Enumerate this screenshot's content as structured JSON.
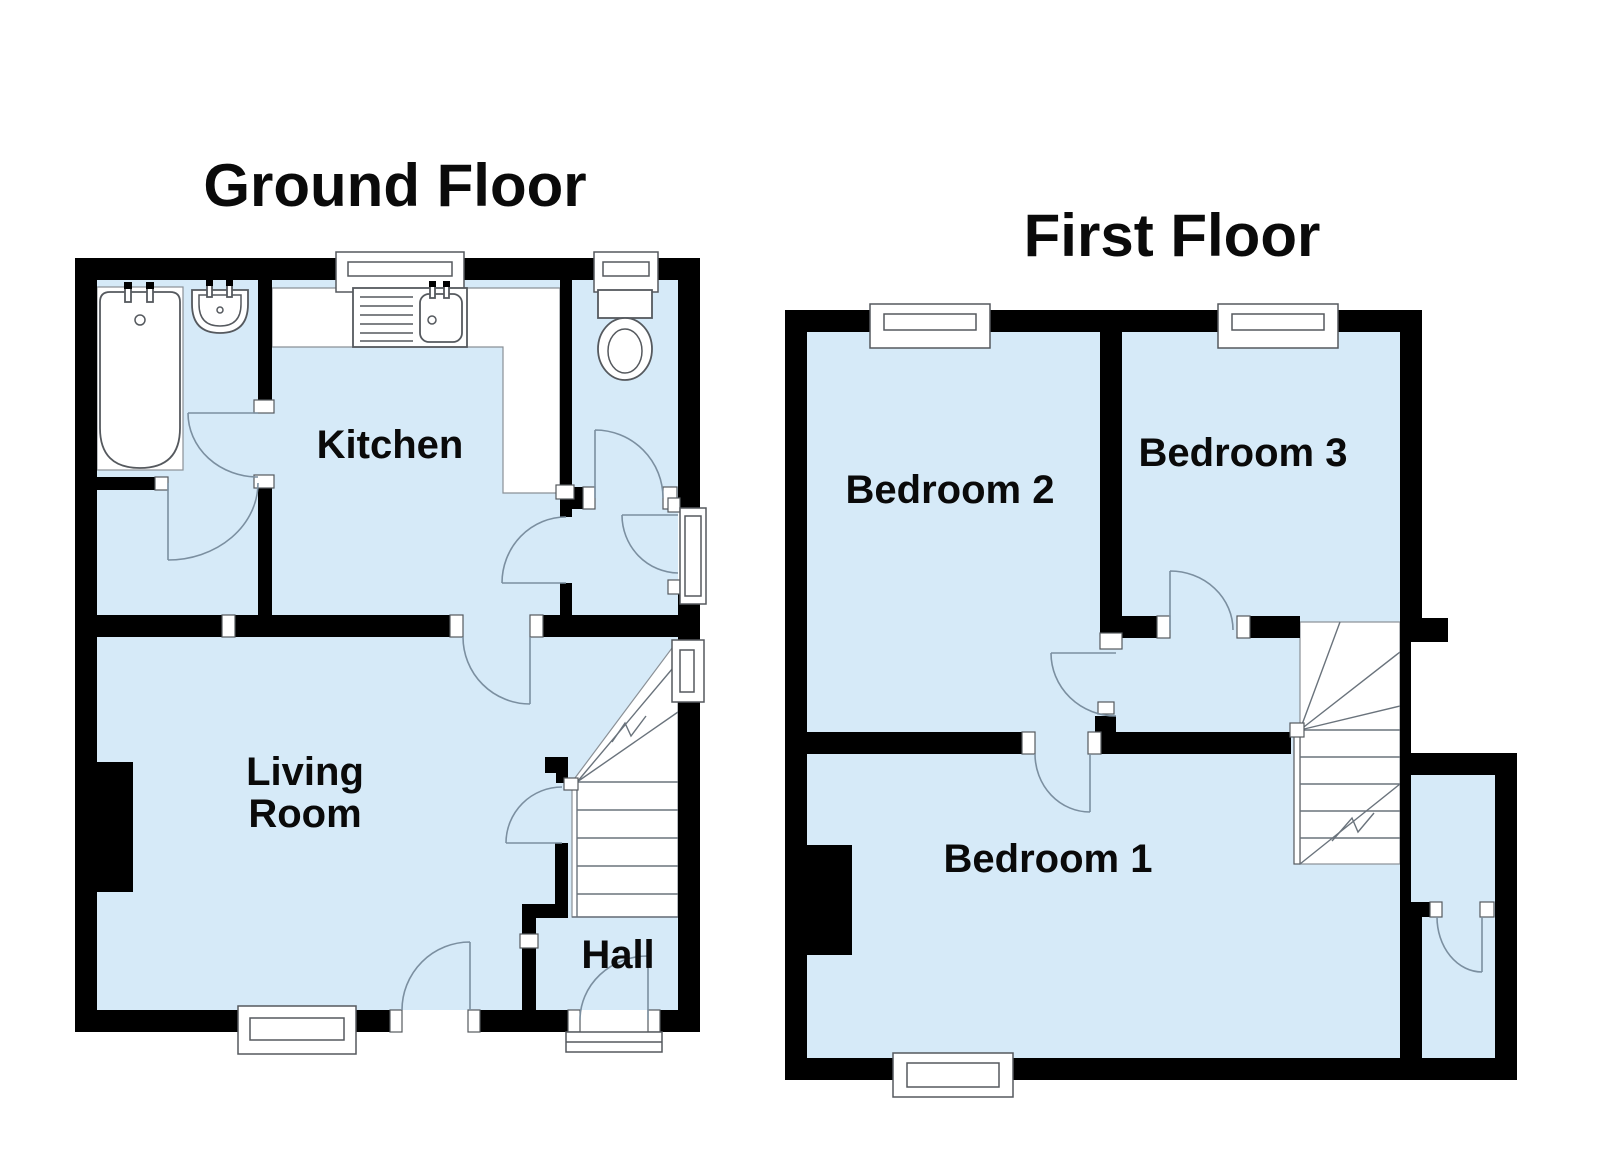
{
  "labels": {
    "ground_title": "Ground Floor",
    "first_title": "First Floor",
    "kitchen": "Kitchen",
    "living_line1": "Living",
    "living_line2": "Room",
    "hall": "Hall",
    "bedroom1": "Bedroom 1",
    "bedroom2": "Bedroom 2",
    "bedroom3": "Bedroom 3"
  },
  "colors": {
    "wall": "#000000",
    "floor_fill": "#d6eaf8",
    "fixture_line": "#55595e",
    "door_swing_line": "#7b8fa0",
    "background": "#ffffff",
    "label_text": "#0a0a0a"
  },
  "fixtures": {
    "ground": [
      "bath-icon",
      "basin-icon",
      "kitchen-sink-icon",
      "toilet-icon",
      "stairs-icon",
      "chimney-breast"
    ],
    "first": [
      "stairs-icon",
      "chimney-breast"
    ]
  },
  "plan": {
    "type": "floorplan",
    "floors": [
      {
        "name": "Ground Floor",
        "rooms": [
          "Kitchen",
          "Living Room",
          "Hall"
        ]
      },
      {
        "name": "First Floor",
        "rooms": [
          "Bedroom 1",
          "Bedroom 2",
          "Bedroom 3"
        ]
      }
    ]
  }
}
